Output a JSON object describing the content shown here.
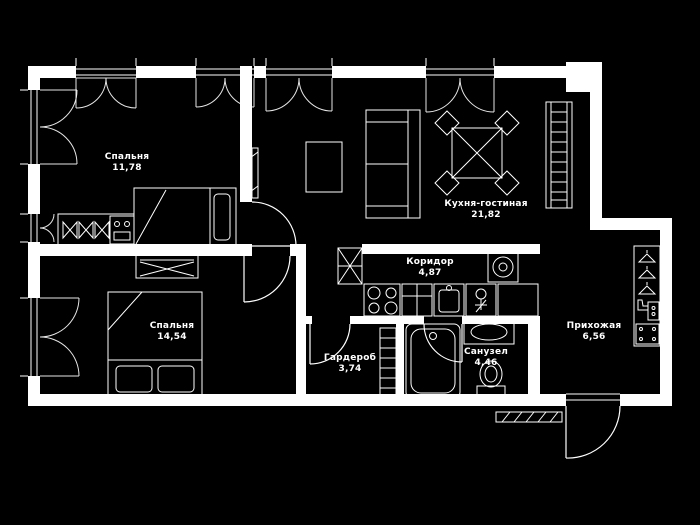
{
  "plan": {
    "background_color": "#000000",
    "line_color": "#ffffff",
    "rooms": [
      {
        "id": "bedroom1",
        "label": "Спальня",
        "area": "11,78"
      },
      {
        "id": "kitchen_living",
        "label": "Кухня-гостиная",
        "area": "21,82"
      },
      {
        "id": "bedroom2",
        "label": "Спальня",
        "area": "14,54"
      },
      {
        "id": "corridor",
        "label": "Коридор",
        "area": "4,87"
      },
      {
        "id": "wardrobe",
        "label": "Гардероб",
        "area": "3,74"
      },
      {
        "id": "bathroom",
        "label": "Санузел",
        "area": "4,46"
      },
      {
        "id": "hallway",
        "label": "Прихожая",
        "area": "6,56"
      }
    ],
    "icons": [
      "bed-icon",
      "hanger-icon",
      "dresser-icon",
      "tv-icon",
      "coffee-table-icon",
      "sofa-icon",
      "dining-table-icon",
      "chair-icon",
      "shelving-icon",
      "vent-shaft-icon",
      "stove-icon",
      "kitchen-counter-icon",
      "kitchen-sink-icon",
      "fridge-icon",
      "washing-machine-icon",
      "bathtub-icon",
      "sink-icon",
      "toilet-icon",
      "coat-rack-icon",
      "shoe-icon",
      "pouf-icon",
      "entrance-door-icon",
      "window-icon",
      "door-arc-icon"
    ]
  }
}
